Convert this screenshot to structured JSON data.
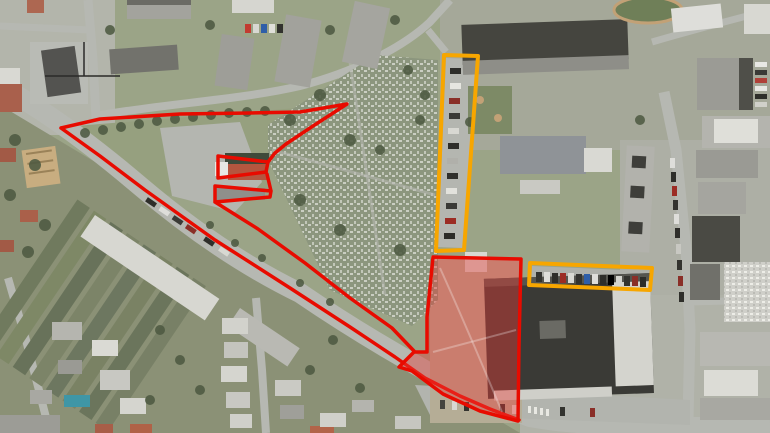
{
  "map": {
    "type": "aerial-satellite-with-parcel-annotations",
    "canvas": {
      "width": 770,
      "height": 433
    },
    "palette": {
      "red_stroke": "#e80b00",
      "red_fill": "rgba(232,60,55,0.42)",
      "yellow_stroke": "#f7a600",
      "road": "#b6b8b2",
      "pavement": "#b4b6b0",
      "grass_park": "#96a07f",
      "grass_general": "#9ba487",
      "cemetery_base": "#8c967e",
      "residential_base": "#8b9176",
      "tree": "#4e5a42",
      "building_gray": "#a3a39d",
      "building_dark": "#45453f",
      "building_white": "#dcdcd6",
      "roof_red": "#a9604c",
      "pool_blue": "#3f96a6"
    },
    "overlays": {
      "shapes": [
        {
          "id": "red-boundary-network",
          "kind": "outline",
          "stroke": "#e80b00",
          "fill": "none",
          "stroke_width": 3.5,
          "d": "M61,128 L100,119 L180,114 L250,113 L300,112 L347,104 L313,126 L286,144 L275,153 L268,162 L218,156 L218,178 L266,172 L268,162 M267,174 L271,191 L215,186 L215,202 L270,197 L271,191 M215,202 L258,229 L305,263 L350,298 L392,328 L414,351 M61,128 L100,156 L145,190 L215,240 L290,288 L350,327 L395,357 L425,378 L460,396 L490,409 L519,420"
        },
        {
          "id": "red-parcel-filled",
          "kind": "filled-parcel",
          "stroke": "#e80b00",
          "fill": "rgba(232,60,55,0.42)",
          "stroke_width": 3.5,
          "d": "M433,257 L521,259 L519,345 L518,421 L480,411 L443,394 L412,371 L399,367 L414,352 L427,352 L427,317 Z"
        },
        {
          "id": "yellow-parcel-north-strip",
          "kind": "outline",
          "stroke": "#f7a600",
          "fill": "none",
          "stroke_width": 4,
          "d": "M444,55 L478,56 L464,250 L436,251 Z"
        },
        {
          "id": "yellow-parcel-east-strip",
          "kind": "outline",
          "stroke": "#f7a600",
          "fill": "none",
          "stroke_width": 4,
          "d": "M530,263 L652,268 L650,290 L529,285 Z"
        }
      ]
    }
  }
}
